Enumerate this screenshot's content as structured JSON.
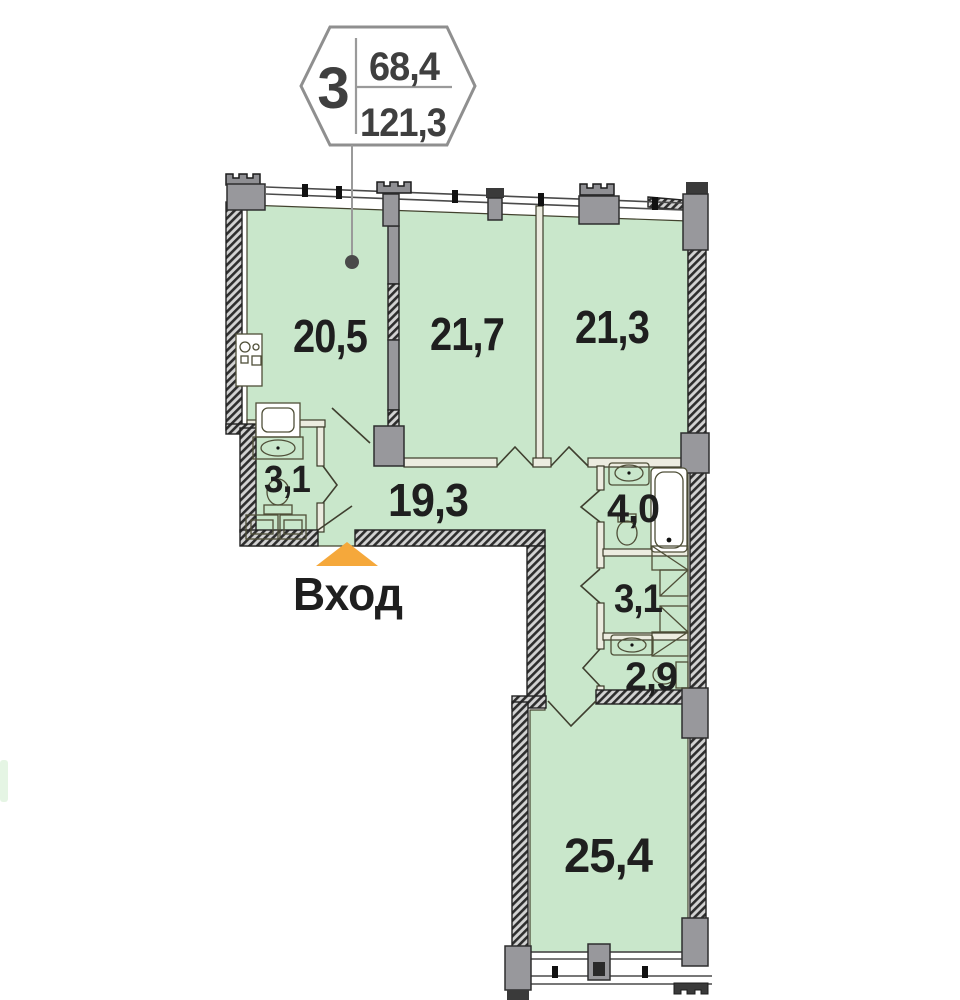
{
  "badge": {
    "rooms_count": "3",
    "upper_area": "68,4",
    "lower_area": "121,3"
  },
  "rooms": [
    {
      "name": "kitchen-living-room",
      "label": "20,5"
    },
    {
      "name": "bedroom-1",
      "label": "21,7"
    },
    {
      "name": "bedroom-2",
      "label": "21,3"
    },
    {
      "name": "bathroom-1",
      "label": "3,1"
    },
    {
      "name": "hallway",
      "label": "19,3"
    },
    {
      "name": "bathroom-2",
      "label": "4,0"
    },
    {
      "name": "storage",
      "label": "3,1"
    },
    {
      "name": "wc",
      "label": "2,9"
    },
    {
      "name": "living-room",
      "label": "25,4"
    }
  ],
  "entrance": {
    "label": "Вход"
  },
  "icons": [
    "stove-icon",
    "washing-machine-icon",
    "sink-icon",
    "toilet-icon",
    "bathtub-icon",
    "wardrobe-icon",
    "entrance-arrow-icon"
  ],
  "colors": {
    "room_fill": "#c9e7cb",
    "wall": "#2e2e2e",
    "wall_hatch_bg": "#d6d6d6",
    "column": "#98989c",
    "entrance_arrow": "#f5a83b",
    "label_text": "#1f1f1f",
    "badge_border": "#8f8f8f",
    "badge_text": "#3f3f3f"
  }
}
